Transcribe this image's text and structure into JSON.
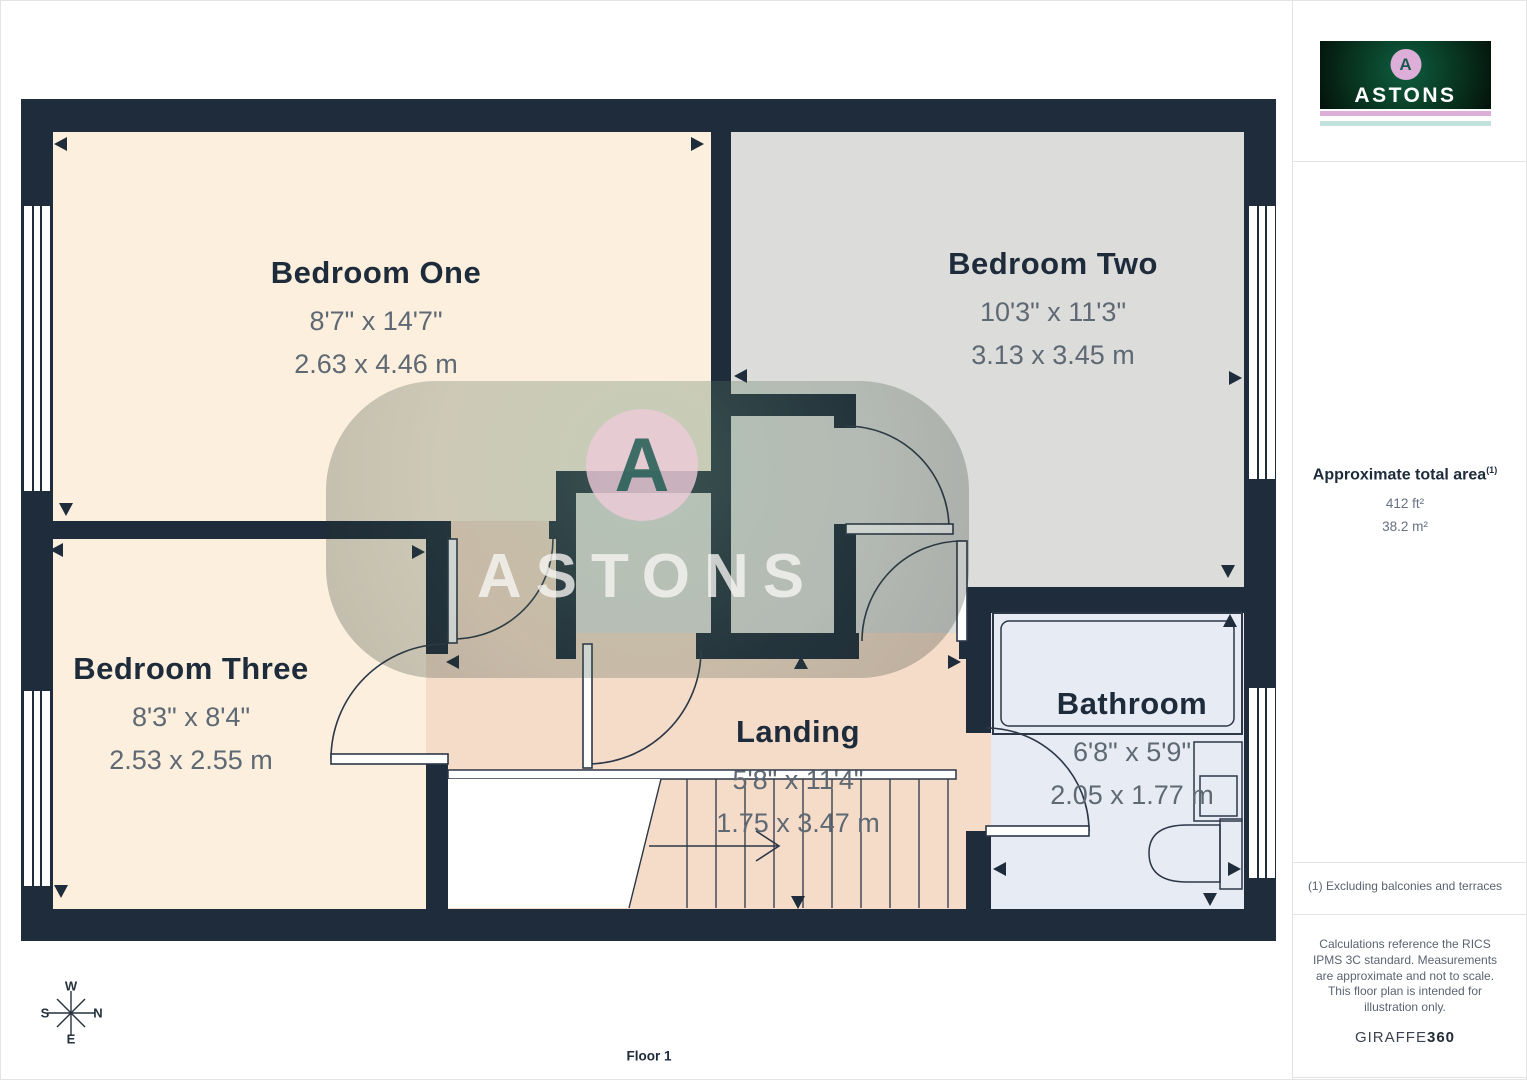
{
  "plan": {
    "rooms": [
      {
        "name": "Bedroom One",
        "imperial": "8'7\" x 14'7\"",
        "metric": "2.63 x 4.46 m"
      },
      {
        "name": "Bedroom Two",
        "imperial": "10'3\" x 11'3\"",
        "metric": "3.13 x 3.45 m"
      },
      {
        "name": "Bedroom Three",
        "imperial": "8'3\" x 8'4\"",
        "metric": "2.53 x 2.55 m"
      },
      {
        "name": "Landing",
        "imperial": "5'8\" x 11'4\"",
        "metric": "1.75 x 3.47 m"
      },
      {
        "name": "Bathroom",
        "imperial": "6'8\" x 5'9\"",
        "metric": "2.05 x 1.77 m"
      }
    ],
    "floor_label": "Floor 1",
    "compass": {
      "west": "W",
      "north": "N",
      "south": "S",
      "east": "E"
    }
  },
  "watermark": {
    "letter": "A",
    "text": "ASTONS"
  },
  "sidebar": {
    "logo": {
      "letter": "A",
      "brand": "ASTONS"
    },
    "area": {
      "heading": "Approximate total area",
      "superscript": "(1)",
      "imperial": "412 ft²",
      "metric": "38.2 m²"
    },
    "footnote": "(1) Excluding balconies and terraces",
    "disclaimer": "Calculations reference the RICS IPMS 3C standard. Measurements are approximate and not to scale. This floor plan is intended for illustration only.",
    "credit": {
      "normal": "GIRAFFE",
      "bold": "360"
    }
  },
  "colors": {
    "wall": "#1e2c3c",
    "bedroom_fill": "#fcefdd",
    "bedroom_two_fill": "#dcdcda",
    "closet_fill": "#e0dfdb",
    "landing_fill": "#f5dcc9",
    "bathroom_fill": "#e7ebf4",
    "label_navy": "#1d2b3b",
    "dim_gray": "#5f6974",
    "brand_pink": "#dcaed8",
    "brand_teal": "#c3e2dc"
  }
}
